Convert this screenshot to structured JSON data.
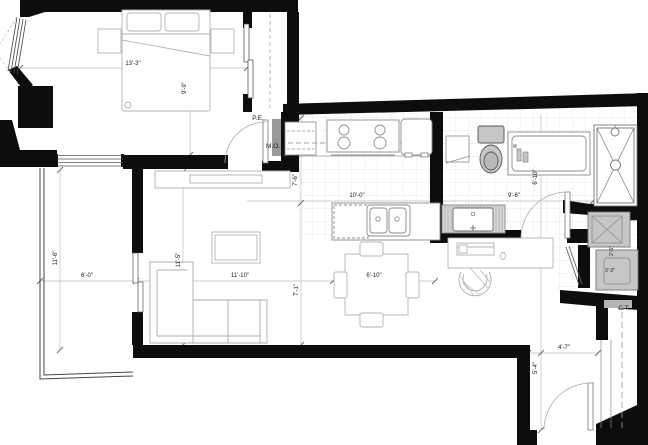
{
  "title": "Apartment unit floor plan",
  "labels": {
    "entry_closet": "P.E.",
    "microwave": "M.O.",
    "corridor": "C.T."
  },
  "dimensions": {
    "bedroom_width": "13'-3\"",
    "bedroom_depth": "9'-9\"",
    "kitchen_depth": "7'-6\"",
    "kitchen_width": "10'-0\"",
    "bath_width": "9'-6\"",
    "bath_depth": "6'-10\"",
    "balcony_depth": "11'-6\"",
    "balcony_width": "6'-0\"",
    "living_depth": "11'-5\"",
    "living_width": "11'-10\"",
    "living_to_wall": "7'-1\"",
    "dining_width": "6'-10\"",
    "entry_width": "4'-7\"",
    "entry_depth": "5'-4\"",
    "laundry_width": "3'-3\"",
    "laundry_depth": "2'-5\""
  },
  "colors": {
    "wall": "#0d0d0d",
    "furniture_line": "#b3b3b3",
    "fixture_fill": "#c6c6c6",
    "tile_line": "#e4e4e4"
  }
}
